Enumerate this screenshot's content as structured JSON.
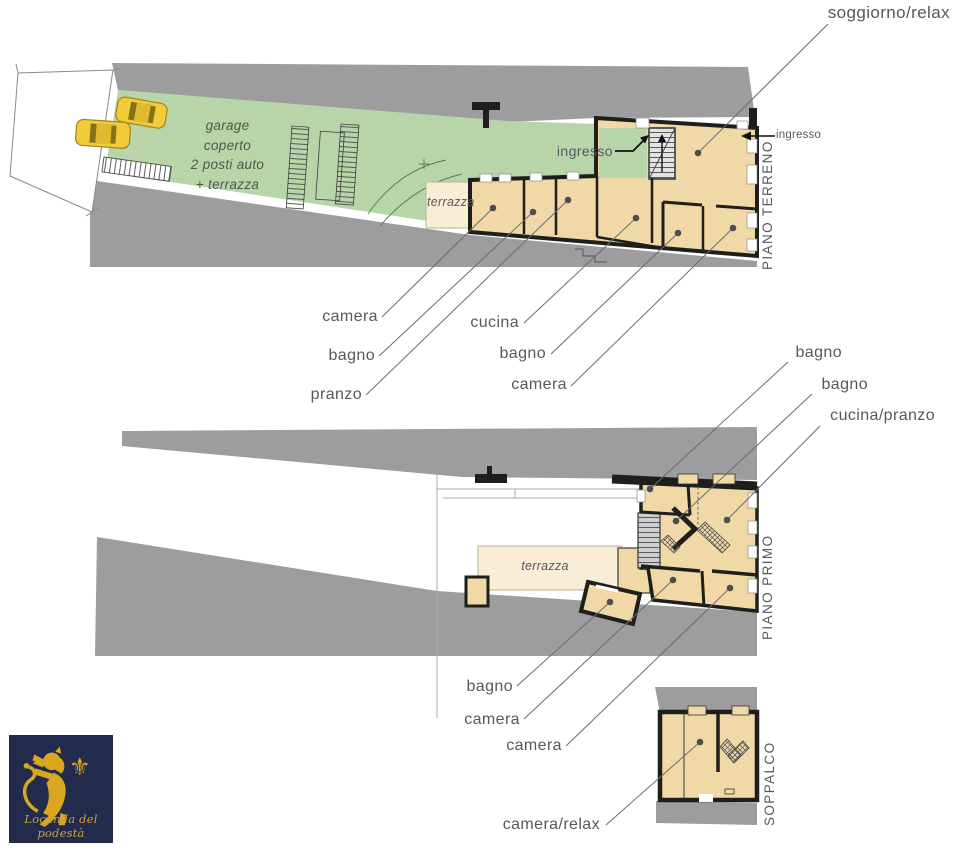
{
  "colors": {
    "road": "#9d9d9d",
    "green": "#b7d5a9",
    "tan": "#f0d9a6",
    "cream": "#f8eed6",
    "wall": "#1e1e1c",
    "ink": "#57585c",
    "leader": "#6a6b6d",
    "yellow": "#f2cb3a",
    "navy": "#232b4d",
    "gold": "#d8a71f",
    "stair": "#d6d6d6"
  },
  "floors": {
    "ground": {
      "title": "PIANO TERRENO",
      "garage_note": "garage\ncoperto\n2 posti auto\n+ terrazza",
      "terrace": "terrazza",
      "entry_interior": "ingresso",
      "entry_exterior": "ingresso",
      "living": "soggiorno/relax",
      "bedroom_left": "camera",
      "bath_left": "bagno",
      "dining": "pranzo",
      "kitchen": "cucina",
      "bath_right": "bagno",
      "bedroom_right": "camera"
    },
    "first": {
      "title": "PIANO PRIMO",
      "terrace": "terrazza",
      "bath_top": "bagno",
      "bath_mid": "bagno",
      "kitchen_dining": "cucina/pranzo",
      "bath_low": "bagno",
      "bedroom_a": "camera",
      "bedroom_b": "camera"
    },
    "mezzanine": {
      "title": "SOPPALCO",
      "bedroom_relax": "camera/relax"
    }
  },
  "logo": {
    "caption": "Locanda del podestà",
    "fleur_glyph": "⚜"
  }
}
